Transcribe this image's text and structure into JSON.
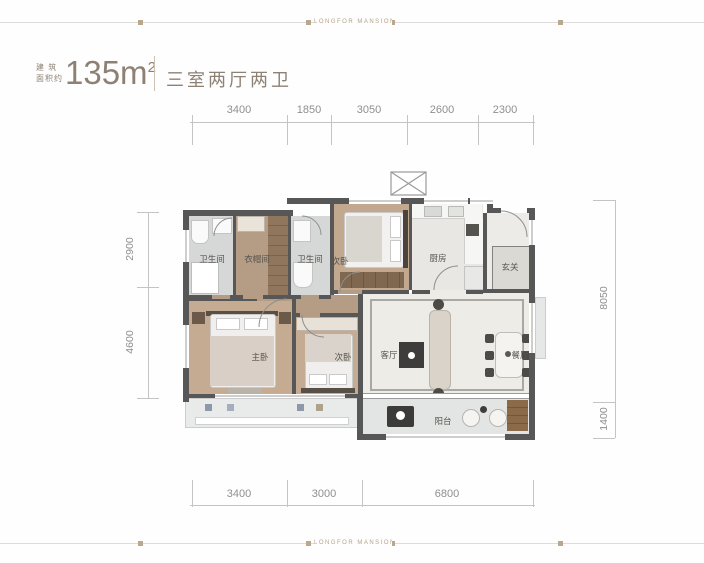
{
  "brand": {
    "name": "LONGFOR MANSION"
  },
  "header": {
    "area_label_line1": "建 筑",
    "area_label_line2": "面积约",
    "area_value": "135m",
    "area_sup": "2",
    "layout_title": "三室两厅两卫"
  },
  "dimensions": {
    "top": [
      "3400",
      "1850",
      "3050",
      "2600",
      "2300"
    ],
    "bottom": [
      "3400",
      "3000",
      "6800"
    ],
    "left": [
      "2900",
      "4600"
    ],
    "right": [
      "8050",
      "1400"
    ]
  },
  "rooms": {
    "bathroom_1": "卫生间",
    "cloakroom": "衣帽间",
    "bathroom_2": "卫生间",
    "bedroom_2": "次卧",
    "kitchen": "厨房",
    "foyer": "玄关",
    "master_bedroom": "主卧",
    "bedroom_3": "次卧",
    "living_room": "客厅",
    "dining_room": "餐厅",
    "balcony": "阳台"
  },
  "colors": {
    "accent": "#8d8174",
    "wall": "#575757",
    "wood_floor": "#c1a88f",
    "corridor_wood": "#b59c84",
    "tile": "#d6d8d8",
    "marble": "#edece7",
    "deco": "#b9a88e",
    "dim_text": "#8f8f8f"
  }
}
